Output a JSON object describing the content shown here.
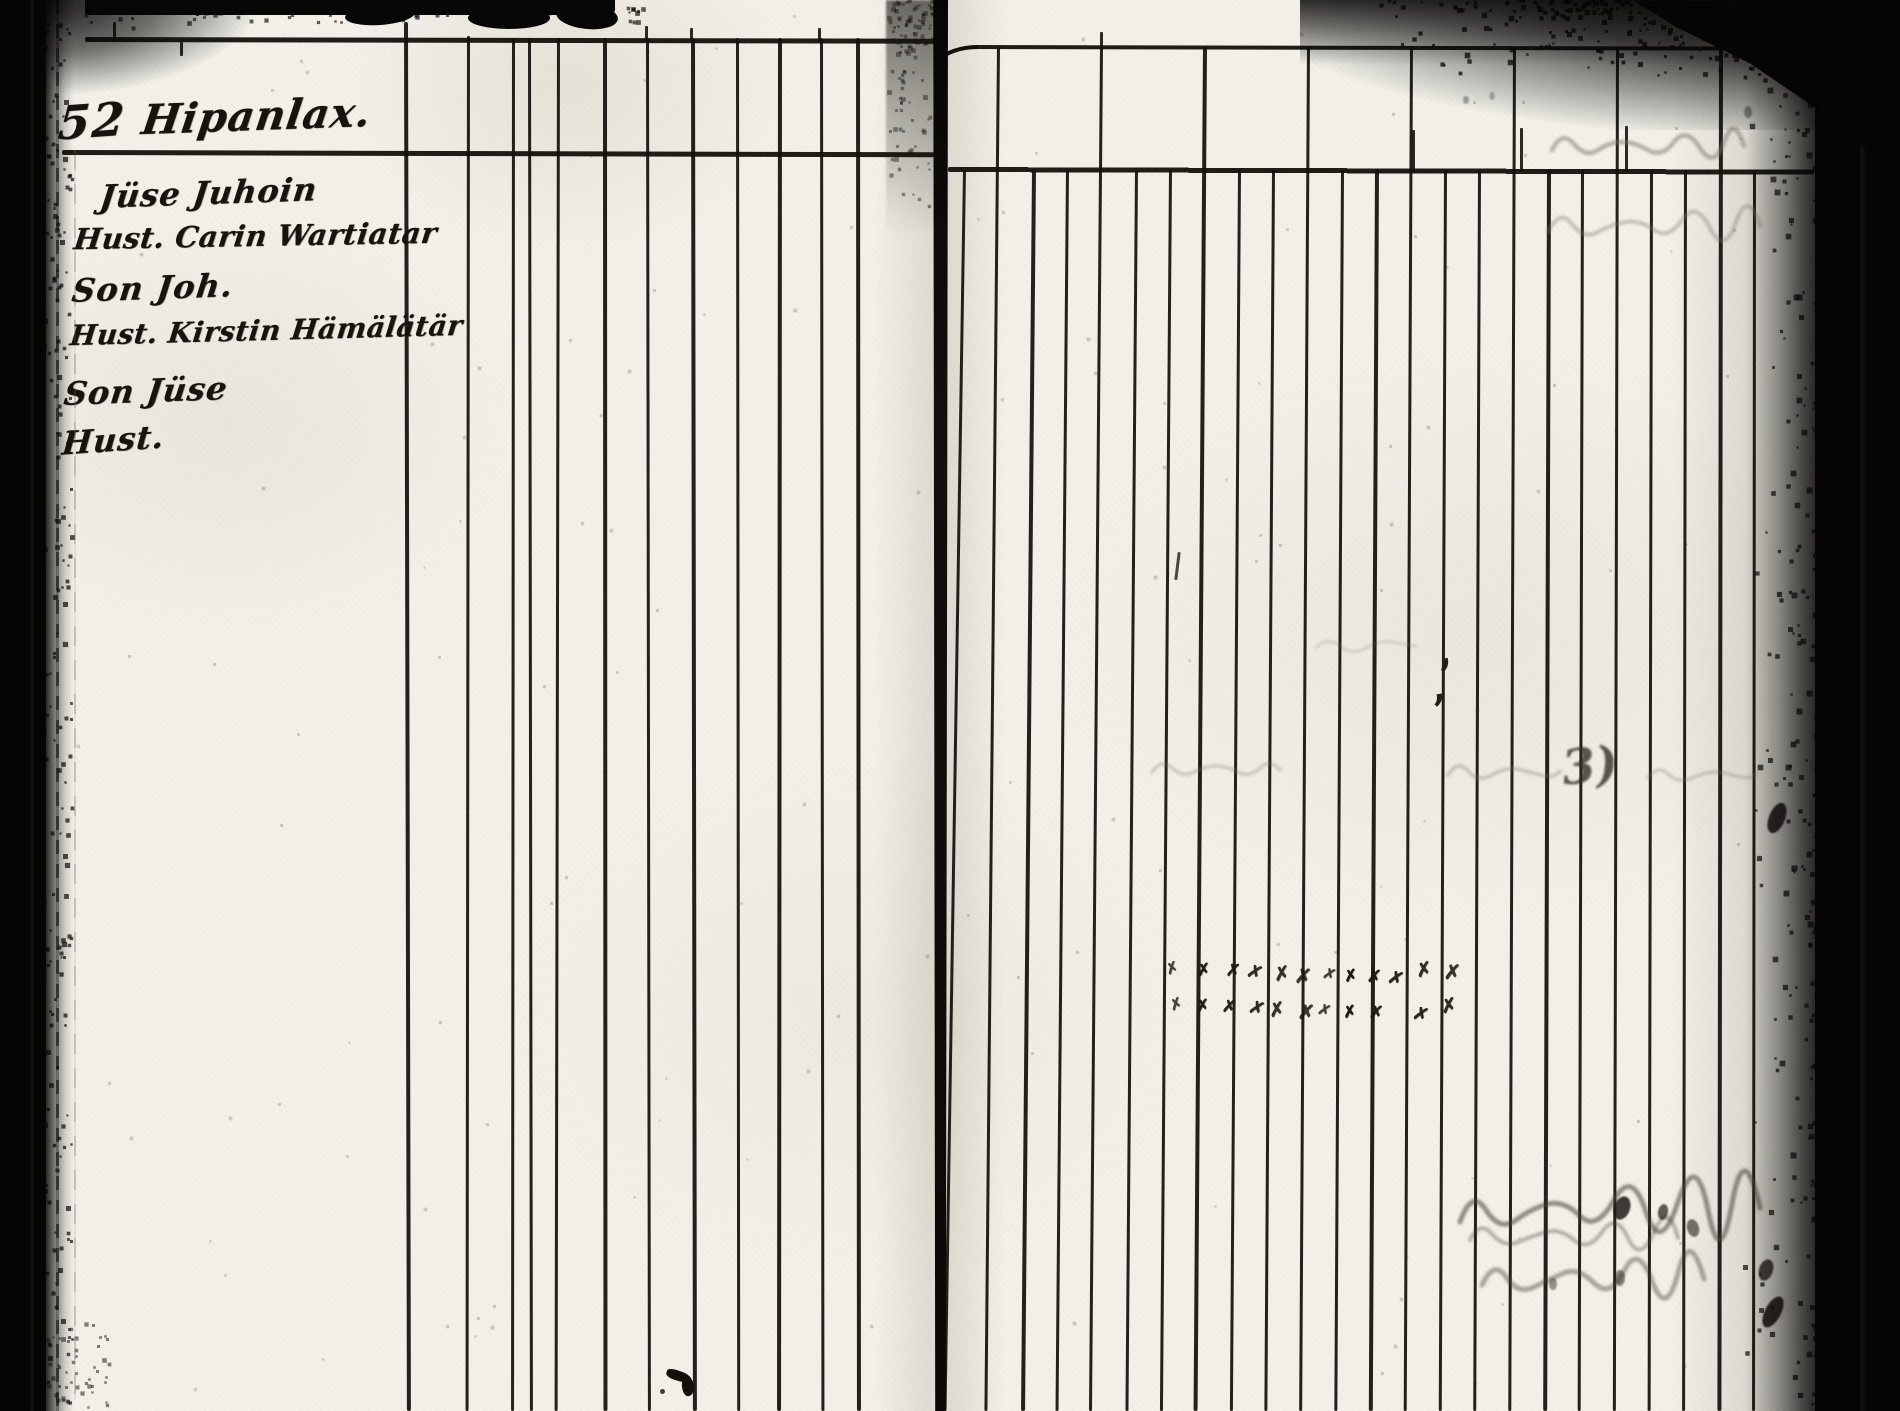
{
  "document": {
    "kind": "scanned handwritten register, two-page ruled ledger spread",
    "left_page": {
      "heading": {
        "number": "52",
        "place_name": "Hipanlax."
      },
      "entries": [
        {
          "text": "Jüse Juhoin"
        },
        {
          "text": "Hust. Carin Wartiatar"
        },
        {
          "text": "Son Joh."
        },
        {
          "text": "Hust. Kirstin Hämälätär"
        },
        {
          "text": "Son Jüse"
        },
        {
          "text": "Hust."
        }
      ]
    },
    "right_page": {
      "tally": {
        "glyph": "✗",
        "row1_count": 12,
        "row2_count": 11
      },
      "bleed_mark": "3)",
      "ink_comma": ","
    },
    "colors": {
      "paper": "#f2f0e9",
      "ink": "#17140f",
      "scan_border": "#050505"
    }
  }
}
